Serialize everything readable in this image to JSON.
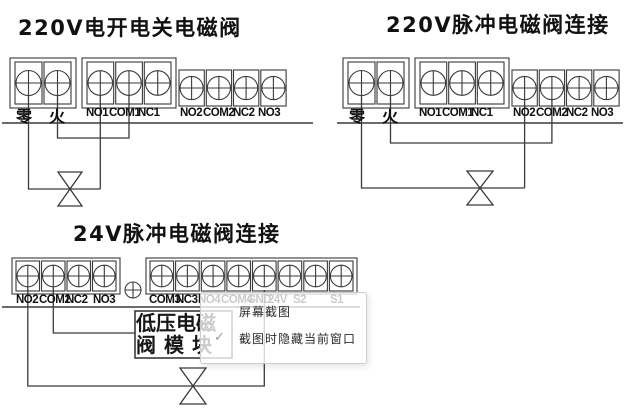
{
  "colors": {
    "line": "#3a3a3a",
    "label": "#101010",
    "popup_border": "#cccccc",
    "check": "#979797"
  },
  "diagrams": [
    {
      "title": "220V电开电关电磁阀",
      "groups": [
        [
          "零",
          "火"
        ],
        [
          "NO1",
          "COM1",
          "NC1"
        ],
        [
          "NO2",
          "COM2",
          "NC2",
          "NO3"
        ]
      ]
    },
    {
      "title": "220V脉冲电磁阀连接",
      "groups": [
        [
          "零",
          "火"
        ],
        [
          "NO1",
          "COM1",
          "NC1"
        ],
        [
          "NO2",
          "COM2",
          "NC2",
          "NO3"
        ]
      ]
    },
    {
      "title": "24V脉冲电磁阀连接",
      "groups": [
        [
          "NO2",
          "COM2",
          "NC2",
          "NO3"
        ],
        [
          "COM3",
          "NC3",
          "NO4",
          "COM4",
          "GND",
          "24V",
          "S2",
          "S1"
        ]
      ]
    }
  ],
  "module_label": {
    "line1": "低压电磁",
    "line2": "阀模块"
  },
  "popup": {
    "check_glyph": "✓",
    "items": [
      {
        "label": "屏幕截图",
        "checked": false
      },
      {
        "label": "截图时隐藏当前窗口",
        "checked": true
      }
    ]
  }
}
